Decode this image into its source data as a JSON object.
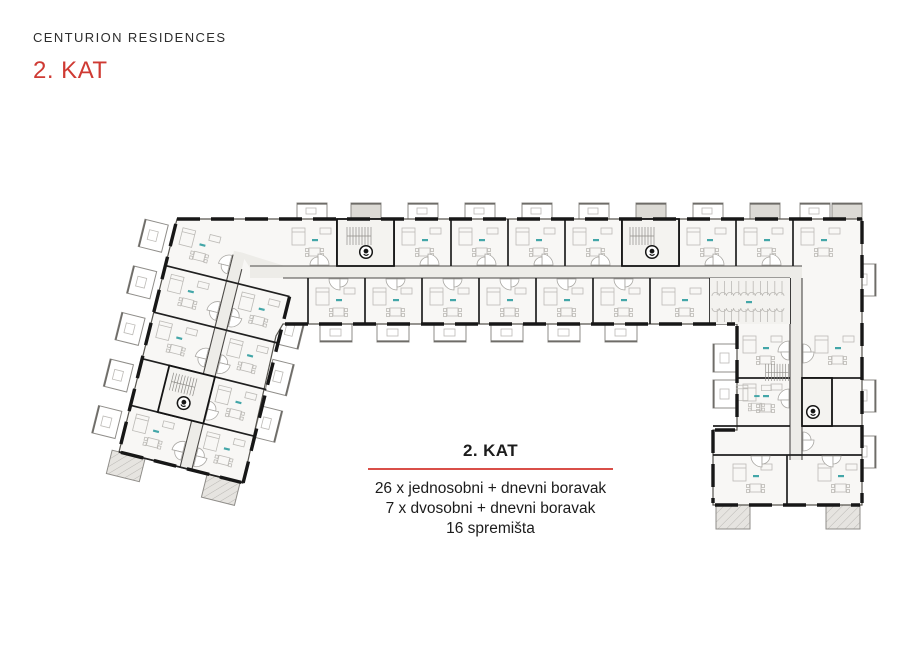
{
  "header": {
    "brand": "CENTURION RESIDENCES",
    "title": "2. KAT"
  },
  "caption": {
    "title": "2. KAT",
    "lines": [
      "26 x jednosobni + dnevni boravak",
      "7 x dvosobni + dnevni boravak",
      "16 spremišta"
    ]
  },
  "plan": {
    "wings": [
      "left-diagonal-wing",
      "top-horizontal-wing",
      "right-vertical-wing"
    ],
    "stair_marker_count": 4,
    "colors": {
      "accent_red": "#cf3a33",
      "rule_red": "#d94f48",
      "wall": "#202020",
      "body_fill": "#f8f7f5",
      "corridor_fill": "#edece8",
      "interior_line": "#bcbab6",
      "room_label_teal": "#43a6a8",
      "balcony_gray": "#dcdad5"
    }
  }
}
